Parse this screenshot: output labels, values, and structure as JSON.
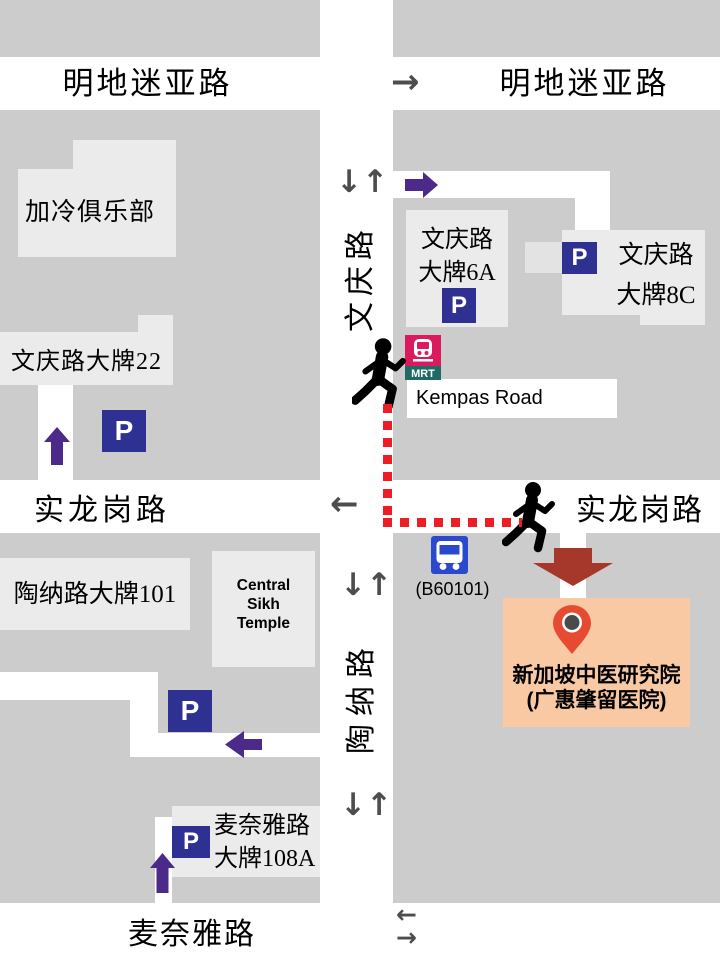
{
  "roads": {
    "bendemeer": "明地迷亚路",
    "boon_keng": "文庆路",
    "serangoon": "实龙岗路",
    "towner": "陶纳路",
    "mcnair": "麦奈雅路",
    "kempas": "Kempas Road"
  },
  "buildings": {
    "kallang_club": "加冷俱乐部",
    "boon_keng_blk22": "文庆路大牌22",
    "boon_keng_blk6a": {
      "line1": "文庆路",
      "line2": "大牌6A"
    },
    "boon_keng_blk8c": {
      "line1": "文庆路",
      "line2": "大牌8C"
    },
    "towner_blk101": "陶纳路大牌101",
    "central_sikh_temple": {
      "line1": "Central",
      "line2": "Sikh",
      "line3": "Temple"
    },
    "mcnair_blk108a": {
      "line1": "麦奈雅路",
      "line2": "大牌108A"
    }
  },
  "destination": {
    "line1": "新加坡中医研究院",
    "line2": "(广惠肇留医院)"
  },
  "transit": {
    "mrt": "MRT",
    "bus_stop": "(B60101)",
    "parking": "P"
  },
  "arrows": {
    "two_way": "↓↑",
    "one_way_right": "→",
    "one_way_left": "←"
  },
  "colors": {
    "block_gray": "#cccccc",
    "building_gray": "#ebebeb",
    "road_white": "#ffffff",
    "parking_blue": "#2e3192",
    "bus_blue": "#2b49cc",
    "mrt_crimson": "#db1a5e",
    "mrt_teal": "#1f6a63",
    "route_purple": "#4b2a8a",
    "walking_route_red": "#ee1c25",
    "destination_arrow_red": "#a5372b",
    "destination_peach": "#f9c9a3",
    "pin_red": "#e64b31",
    "direction_arrow_gray": "#4d4d4d"
  }
}
